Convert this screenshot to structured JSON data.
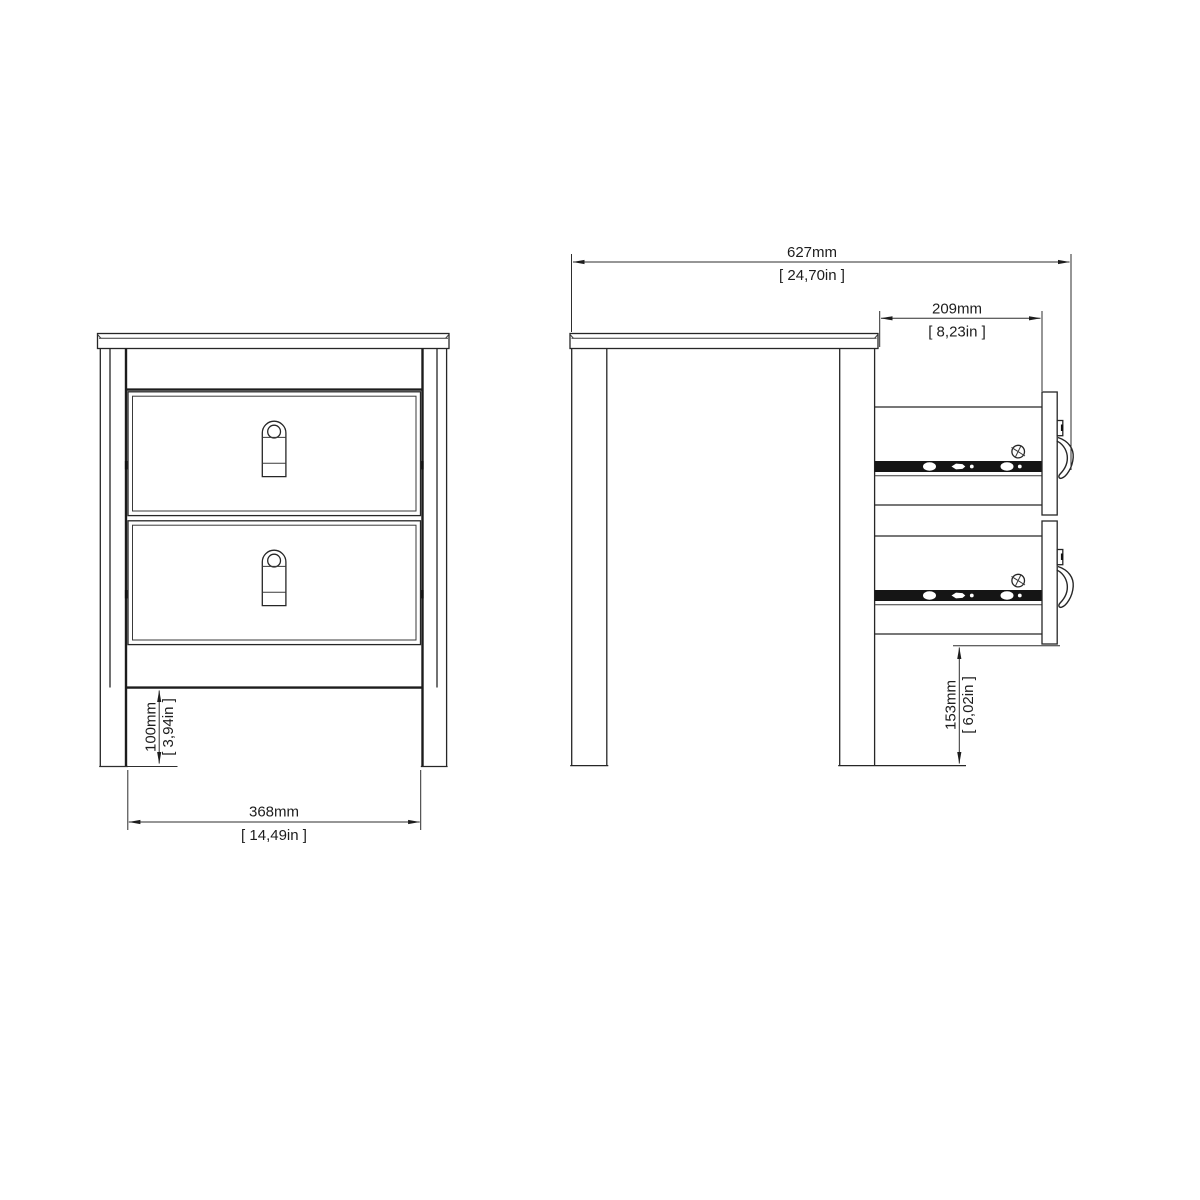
{
  "drawing": {
    "background": "#ffffff",
    "line_color": "#262626",
    "rail_fill": "#151515",
    "views": {
      "front": {
        "drawer_count": 2,
        "dims": {
          "width": {
            "mm": "368mm",
            "inch": "[ 14,49in ]"
          },
          "plinth": {
            "mm": "100mm",
            "inch": "[ 3,94in ]"
          }
        }
      },
      "side": {
        "drawer_count": 2,
        "dims": {
          "depth": {
            "mm": "627mm",
            "inch": "[ 24,70in ]"
          },
          "drawer": {
            "mm": "209mm",
            "inch": "[ 8,23in ]"
          },
          "clearance": {
            "mm": "153mm",
            "inch": "[ 6,02in ]"
          }
        }
      }
    }
  }
}
